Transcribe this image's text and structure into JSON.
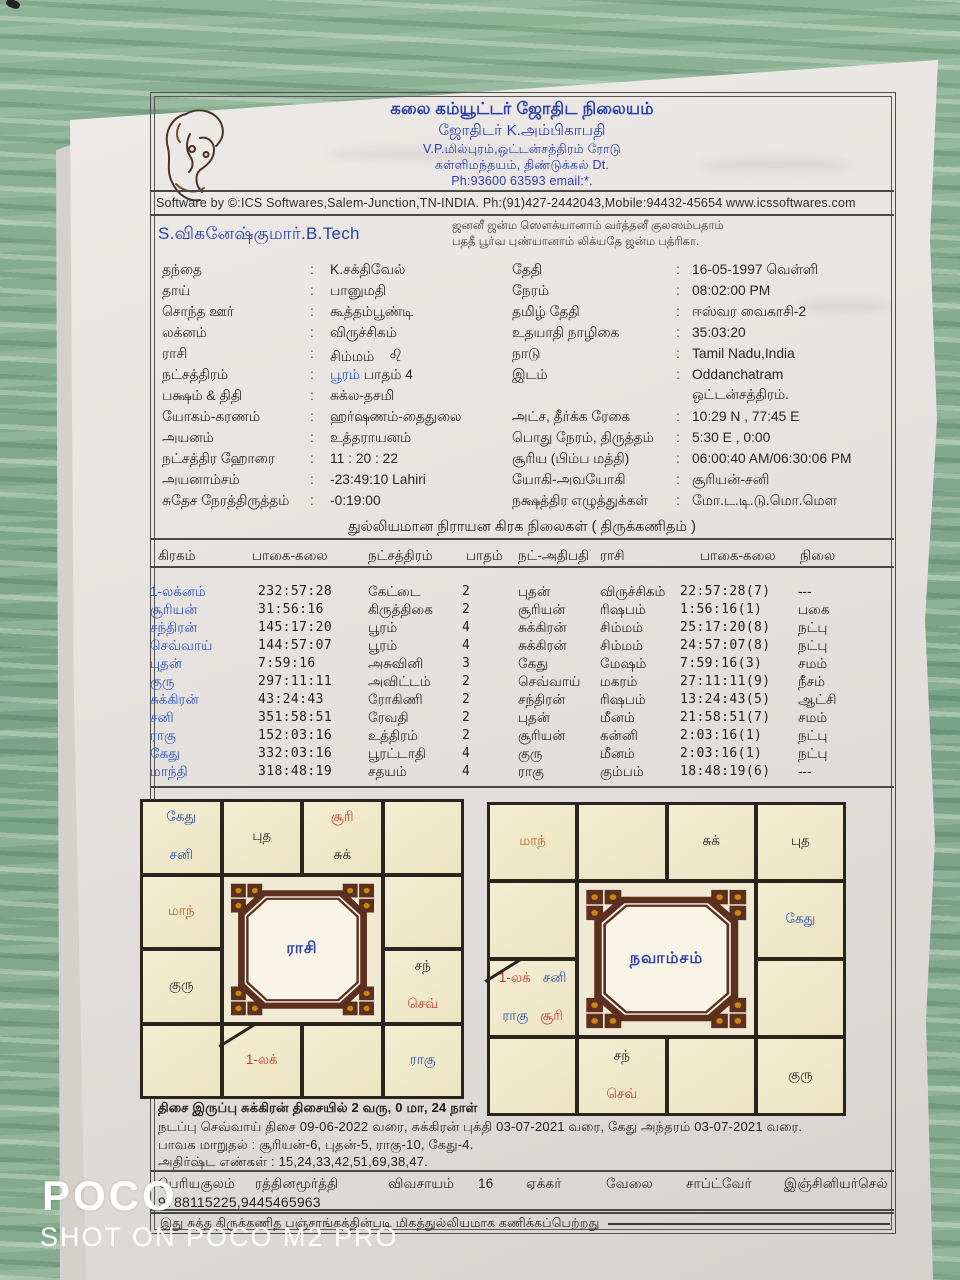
{
  "header": {
    "org_line1": "கலை கம்யூட்டர் ஜோதிட நிலையம்",
    "org_line2": "ஜோதிடர் K.அம்பிகாபதி",
    "org_line3": "V.P.மில்புரம்,ஒட்டன்சத்திரம் ரோடு",
    "org_line4": "கள்ளிமந்தயம், திண்டுக்கல் Dt.",
    "org_line5": "Ph:93600 63593 email:*.",
    "software_line": "Software by ©:ICS Softwares,Salem-Junction,TN-INDIA. Ph:(91)427-2442043,Mobile:94432-45654 www.icssoftwares.com",
    "blessing_line1": "ஜனனீ ஜன்ம ஸௌக்யானாம் வர்த்தனீ குலஸம்பதாம்",
    "blessing_line2": "பததீ பூர்வ புண்யானாம் லிக்யதே ஜன்ம பத்ரிகா.",
    "person_name": "S.விகனேஷ்குமார்.B.Tech"
  },
  "details": {
    "left_rows": [
      {
        "label": "தந்தை",
        "value": "K.சக்திவேல்"
      },
      {
        "label": "தாய்",
        "value": "பானுமதி"
      },
      {
        "label": "சொந்த ஊர்",
        "value": "கூத்தம்பூண்டி"
      },
      {
        "label": "லக்னம்",
        "value": "விருச்சிகம்"
      },
      {
        "label": "ராசி",
        "value": "சிம்மம்",
        "glyph": "♌"
      },
      {
        "label": "நட்சத்திரம்",
        "accent": "பூரம்",
        "value": " பாதம்  4"
      },
      {
        "label": "பக்ஷம் & திதி",
        "value": "சுக்ல-தசமி"
      },
      {
        "label": "யோகம்-கரணம்",
        "value": "ஹர்ஷணம்-தைதுலை"
      },
      {
        "label": "அயனம்",
        "value": "உத்தராயனம்"
      },
      {
        "label": "நட்சத்திர ஹோரை",
        "value": "11 : 20 : 22"
      },
      {
        "label": "அயனாம்சம்",
        "value": "-23:49:10 Lahiri"
      },
      {
        "label": "சுதேச நேரத்திருத்தம்",
        "value": "-0:19:00"
      }
    ],
    "right_rows": [
      {
        "label": "தேதி",
        "value": "16-05-1997 வெள்ளி"
      },
      {
        "label": "நேரம்",
        "value": "08:02:00 PM"
      },
      {
        "label": "தமிழ் தேதி",
        "value": "ஈஸ்வர  வைகாசி-2"
      },
      {
        "label": "உதயாதி நாழிகை",
        "value": "35:03:20"
      },
      {
        "label": "நாடு",
        "value": "Tamil Nadu,India"
      },
      {
        "label": "இடம்",
        "value": "Oddanchatram",
        "value2": "ஒட்டன்சத்திரம்."
      },
      {
        "label": "அட்ச, தீர்க்க ரேகை",
        "value": "10:29 N , 77:45 E"
      },
      {
        "label": "பொது நேரம், திருத்தம்",
        "value": "5:30 E , 0:00"
      },
      {
        "label": "சூரிய (பிம்ப மத்தி)",
        "value": "06:00:40 AM/06:30:06 PM"
      },
      {
        "label": "யோகி-அவயோகி",
        "value": "சூரியன்-சனி"
      },
      {
        "label": "நக்ஷத்திர எழுத்துக்கள்",
        "value": "மோ.ட.டி.டு.மொ.மௌ"
      }
    ]
  },
  "planet_table": {
    "title": "துல்லியமான நிராயன கிரக நிலைகள் ( திருக்கணிதம் )",
    "headers": [
      "கிரகம்",
      "பாகை-கலை",
      "நட்சத்திரம்",
      "பாதம்",
      "நட்-அதிபதி",
      "ராசி",
      "பாகை-கலை",
      "நிலை"
    ],
    "rows": [
      [
        "1-லக்னம்",
        "232:57:28",
        "கேட்டை",
        "2",
        "புதன்",
        "விருச்சிகம்",
        "22:57:28(7)",
        "---"
      ],
      [
        "சூரியன்",
        "31:56:16",
        "கிருத்திகை",
        "2",
        "சூரியன்",
        "ரிஷபம்",
        "1:56:16(1)",
        "பகை"
      ],
      [
        "சந்திரன்",
        "145:17:20",
        "பூரம்",
        "4",
        "சுக்கிரன்",
        "சிம்மம்",
        "25:17:20(8)",
        "நட்பு"
      ],
      [
        "செவ்வாய்",
        "144:57:07",
        "பூரம்",
        "4",
        "சுக்கிரன்",
        "சிம்மம்",
        "24:57:07(8)",
        "நட்பு"
      ],
      [
        "புதன்",
        "7:59:16",
        "அசுவினி",
        "3",
        "கேது",
        "மேஷம்",
        "7:59:16(3)",
        "சமம்"
      ],
      [
        "குரு",
        "297:11:11",
        "அவிட்டம்",
        "2",
        "செவ்வாய்",
        "மகரம்",
        "27:11:11(9)",
        "நீசம்"
      ],
      [
        "சுக்கிரன்",
        "43:24:43",
        "ரோகிணி",
        "2",
        "சந்திரன்",
        "ரிஷபம்",
        "13:24:43(5)",
        "ஆட்சி"
      ],
      [
        "சனி",
        "351:58:51",
        "ரேவதி",
        "2",
        "புதன்",
        "மீனம்",
        "21:58:51(7)",
        "சமம்"
      ],
      [
        "ராகு",
        "152:03:16",
        "உத்திரம்",
        "2",
        "சூரியன்",
        "கன்னி",
        "2:03:16(1)",
        "நட்பு"
      ],
      [
        "கேது",
        "332:03:16",
        "பூரட்டாதி",
        "4",
        "குரு",
        "மீனம்",
        "2:03:16(1)",
        "நட்பு"
      ],
      [
        "மாந்தி",
        "318:48:19",
        "சதயம்",
        "4",
        "ராகு",
        "கும்பம்",
        "18:48:19(6)",
        "---"
      ]
    ]
  },
  "charts": [
    {
      "title": "ராசி",
      "cells": [
        {
          "pos": "r0c0",
          "lines": [
            [
              {
                "t": "கேது",
                "c": "blue"
              }
            ],
            [
              {
                "t": "சனி",
                "c": "blue"
              }
            ]
          ]
        },
        {
          "pos": "r0c1",
          "lines": [
            [
              {
                "t": "புத",
                "c": "black"
              }
            ]
          ]
        },
        {
          "pos": "r0c2",
          "lines": [
            [
              {
                "t": "சூரி",
                "c": "red"
              }
            ],
            [
              {
                "t": "சுக்",
                "c": "black"
              }
            ]
          ]
        },
        {
          "pos": "r0c3",
          "lines": []
        },
        {
          "pos": "r1c0",
          "lines": [
            [
              {
                "t": "மாந்",
                "c": "orange"
              }
            ]
          ]
        },
        {
          "pos": "r1c3",
          "lines": []
        },
        {
          "pos": "r2c0",
          "lines": [
            [
              {
                "t": "குரு",
                "c": "black"
              }
            ]
          ]
        },
        {
          "pos": "r2c3",
          "lines": [
            [
              {
                "t": "சந்",
                "c": "black"
              }
            ],
            [
              {
                "t": "செவ்",
                "c": "red"
              }
            ]
          ]
        },
        {
          "pos": "r3c0",
          "lines": []
        },
        {
          "pos": "r3c1",
          "lagna": true,
          "lines": [
            [
              {
                "t": "1-லக்",
                "c": "red"
              }
            ]
          ]
        },
        {
          "pos": "r3c2",
          "lines": []
        },
        {
          "pos": "r3c3",
          "lines": [
            [
              {
                "t": "ராகு",
                "c": "blue"
              }
            ]
          ]
        }
      ]
    },
    {
      "title": "நவாம்சம்",
      "cells": [
        {
          "pos": "r0c0",
          "lines": [
            [
              {
                "t": "மாந்",
                "c": "orange"
              }
            ]
          ]
        },
        {
          "pos": "r0c1",
          "lines": []
        },
        {
          "pos": "r0c2",
          "lines": [
            [
              {
                "t": "சுக்",
                "c": "black"
              }
            ]
          ]
        },
        {
          "pos": "r0c3",
          "lines": [
            [
              {
                "t": "புத",
                "c": "black"
              }
            ]
          ]
        },
        {
          "pos": "r1c0",
          "lines": []
        },
        {
          "pos": "r1c3",
          "lines": [
            [
              {
                "t": "கேது",
                "c": "blue"
              }
            ]
          ]
        },
        {
          "pos": "r2c0",
          "lagna": true,
          "lines": [
            [
              {
                "t": "1-லக்",
                "c": "red"
              },
              {
                "t": "சனி",
                "c": "blue"
              }
            ],
            [
              {
                "t": "ராகு",
                "c": "blue"
              },
              {
                "t": "சூரி",
                "c": "red"
              }
            ]
          ]
        },
        {
          "pos": "r2c3",
          "lines": []
        },
        {
          "pos": "r3c0",
          "lines": []
        },
        {
          "pos": "r3c1",
          "lines": [
            [
              {
                "t": "சந்",
                "c": "black"
              }
            ],
            [
              {
                "t": "செவ்",
                "c": "red"
              }
            ]
          ]
        },
        {
          "pos": "r3c2",
          "lines": []
        },
        {
          "pos": "r3c3",
          "lines": [
            [
              {
                "t": "குரு",
                "c": "black"
              }
            ]
          ]
        }
      ]
    }
  ],
  "footer": {
    "dasa_line1": "திசை இருப்பு சுக்கிரன் திசையில் 2 வரு, 0 மா, 24 நாள்",
    "dasa_line2": "நடப்பு செவ்வாய் திசை 09-06-2022 வரை, சுக்கிரன் புக்தி 03-07-2021 வரை, கேது அந்தரம் 03-07-2021 வரை.",
    "bhava_line": "பாவக மாறுதல் : சூரியன்-6, புதன்-5, ராகு-10, கேது-4.",
    "lucky_line": "அதிர்ஷ்ட எண்கள் : 15,24,33,42,51,69,38,47.",
    "family_row": [
      "பெரியகுலம்",
      "ரத்தினமூர்த்தி",
      "விவசாயம்",
      "16",
      "ஏக்கர்",
      "வேலை",
      "சாப்ட்வேர்",
      "இஞ்சினியர்செல்"
    ],
    "phone_line": "9788115225,9445465963",
    "closing_line": "இது சுத்த திருக்கணித பஞ்சாங்கத்தின்படி மிகத்துல்லியமாக கணிக்கப்பெற்றது"
  },
  "watermark": {
    "title": "POCO",
    "subtitle": "SHOT ON POCO M2 PRO"
  },
  "colors": {
    "blue": "#2a4fae",
    "red": "#c23b2a",
    "orange": "#c05c1a",
    "black": "#20201e",
    "kolam": "#5d2f1f",
    "gold": "#c8860a"
  }
}
